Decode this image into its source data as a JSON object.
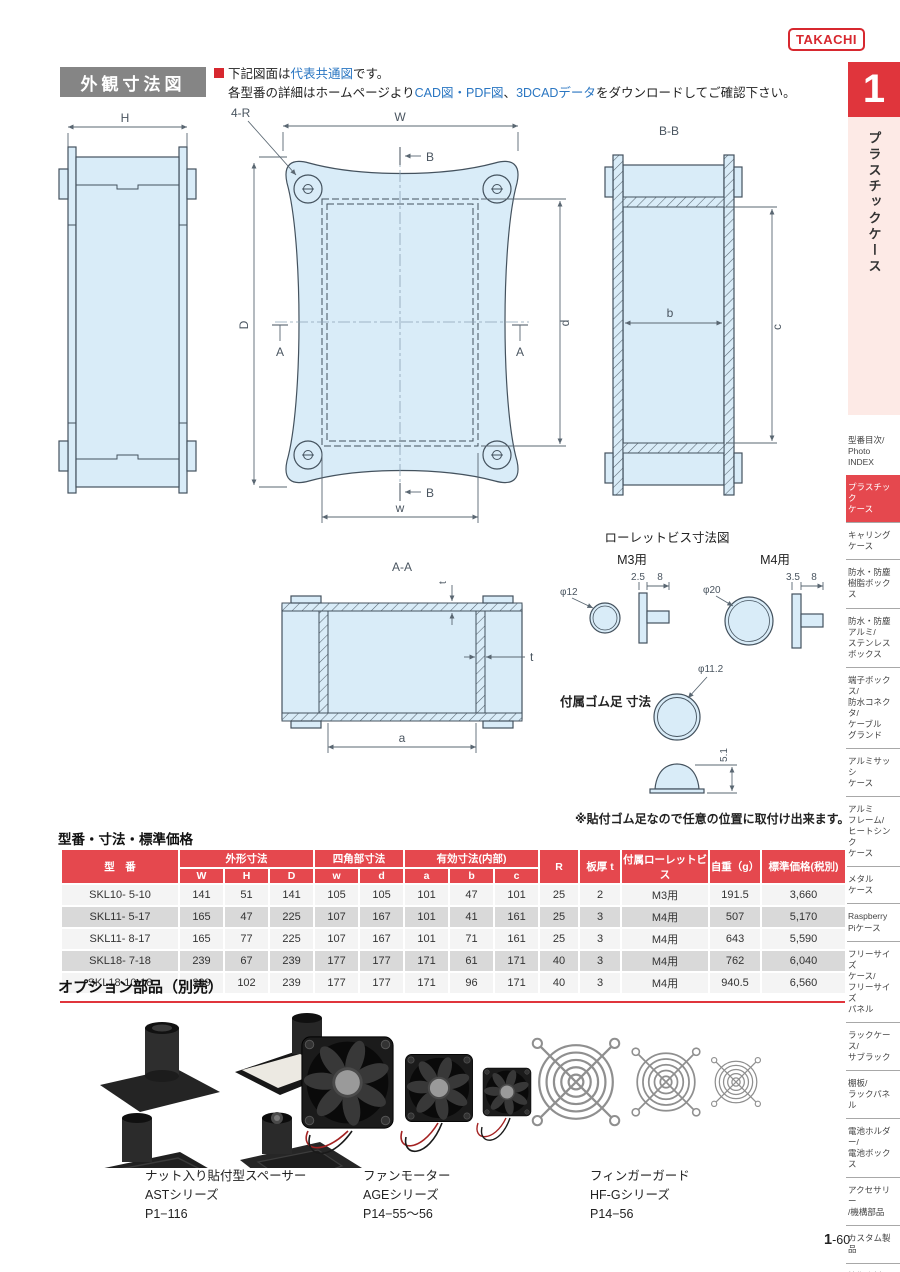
{
  "logo": {
    "text": "TAKACHI"
  },
  "tab": {
    "number": "1",
    "label": "プラスチックケース"
  },
  "section": {
    "title": "外観寸法図",
    "note1_pre": "下記図面は",
    "note1_em": "代表共通図",
    "note1_post": "です。",
    "note2_pre": "各型番の詳細はホームページより",
    "note2_em1": "CAD図・PDF図",
    "note2_mid": "、",
    "note2_em2": "3DCADデータ",
    "note2_post": "をダウンロードしてご確認下さい。"
  },
  "diagrams": {
    "side_view": {
      "dim_h": "H"
    },
    "top_view": {
      "corner": "4-R",
      "dim_W": "W",
      "dim_w": "w",
      "dim_D": "D",
      "dim_d": "d",
      "mark_a": "A",
      "mark_b": "B"
    },
    "section_bb": {
      "title": "B-B",
      "dim_b": "b",
      "dim_c": "c"
    },
    "section_aa": {
      "title": "A-A",
      "dim_t": "t",
      "dim_a": "a"
    },
    "screws": {
      "title": "ローレットビス寸法図",
      "m3_label": "M3用",
      "m3_dia": "φ12",
      "m3_d1": "2.5",
      "m3_d2": "8",
      "m4_label": "M4用",
      "m4_dia": "φ20",
      "m4_d1": "3.5",
      "m4_d2": "8"
    },
    "foot": {
      "label": "付属ゴム足 寸法",
      "dia": "φ11.2",
      "height": "5.1",
      "note": "※貼付ゴム足なので任意の位置に取付け出来ます。"
    }
  },
  "table": {
    "caption": "型番・寸法・標準価格",
    "h_model": "型　番",
    "h_outer": "外形寸法",
    "h_square": "四角部寸法",
    "h_effective": "有効寸法(内部)",
    "h_sub": [
      "W",
      "H",
      "D",
      "w",
      "d",
      "a",
      "b",
      "c"
    ],
    "h_r": "R",
    "h_thickness": "板厚 t",
    "h_screw": "付属ローレットビス",
    "h_weight": "自重（g）",
    "h_price": "標準価格(税別)",
    "rows": [
      [
        "SKL10- 5-10",
        "141",
        "51",
        "141",
        "105",
        "105",
        "101",
        "47",
        "101",
        "25",
        "2",
        "M3用",
        "191.5",
        "3,660"
      ],
      [
        "SKL11- 5-17",
        "165",
        "47",
        "225",
        "107",
        "167",
        "101",
        "41",
        "161",
        "25",
        "3",
        "M4用",
        "507",
        "5,170"
      ],
      [
        "SKL11- 8-17",
        "165",
        "77",
        "225",
        "107",
        "167",
        "101",
        "71",
        "161",
        "25",
        "3",
        "M4用",
        "643",
        "5,590"
      ],
      [
        "SKL18- 7-18",
        "239",
        "67",
        "239",
        "177",
        "177",
        "171",
        "61",
        "171",
        "40",
        "3",
        "M4用",
        "762",
        "6,040"
      ],
      [
        "SKL18-10-18",
        "239",
        "102",
        "239",
        "177",
        "177",
        "171",
        "96",
        "171",
        "40",
        "3",
        "M4用",
        "940.5",
        "6,560"
      ]
    ]
  },
  "options": {
    "title": "オプション部品（別売）",
    "items": [
      {
        "name": "ナット入り貼付型スペーサー",
        "series": "ASTシリーズ",
        "page": "P1−116",
        "image": "spacer-set"
      },
      {
        "name": "ファンモーター",
        "series": "AGEシリーズ",
        "page": "P14−55〜56",
        "image": "fan-motors"
      },
      {
        "name": "フィンガーガード",
        "series": "HF-Gシリーズ",
        "page": "P14−56",
        "image": "finger-guards"
      }
    ]
  },
  "sidebar": {
    "items": [
      {
        "label": "型番目次/\nPhoto\nINDEX",
        "active": false
      },
      {
        "label": "プラスチック\nケース",
        "active": true
      },
      {
        "label": "キャリング\nケース",
        "active": false
      },
      {
        "label": "防水・防塵\n樹脂ボックス",
        "active": false
      },
      {
        "label": "防水・防塵\nアルミ/\nステンレス\nボックス",
        "active": false
      },
      {
        "label": "端子ボックス/\n防水コネクタ/\nケーブル\nグランド",
        "active": false
      },
      {
        "label": "アルミサッシ\nケース",
        "active": false
      },
      {
        "label": "アルミ\nフレーム/\nヒートシンク\nケース",
        "active": false
      },
      {
        "label": "メタル\nケース",
        "active": false
      },
      {
        "label": "Raspberry\nPiケース",
        "active": false
      },
      {
        "label": "フリーサイズ\nケース/\nフリーサイズ\nパネル",
        "active": false
      },
      {
        "label": "ラックケース/\nサブラック",
        "active": false
      },
      {
        "label": "棚板/\nラックパネル",
        "active": false
      },
      {
        "label": "電池ホルダー/\n電池ボックス",
        "active": false
      },
      {
        "label": "アクセサリー\n/機構部品",
        "active": false
      },
      {
        "label": "カスタム製品",
        "active": false
      },
      {
        "label": "技術資料/\n各種ご案内",
        "active": false
      }
    ]
  },
  "footer": {
    "page_num": "1",
    "page_rest": "-60"
  }
}
